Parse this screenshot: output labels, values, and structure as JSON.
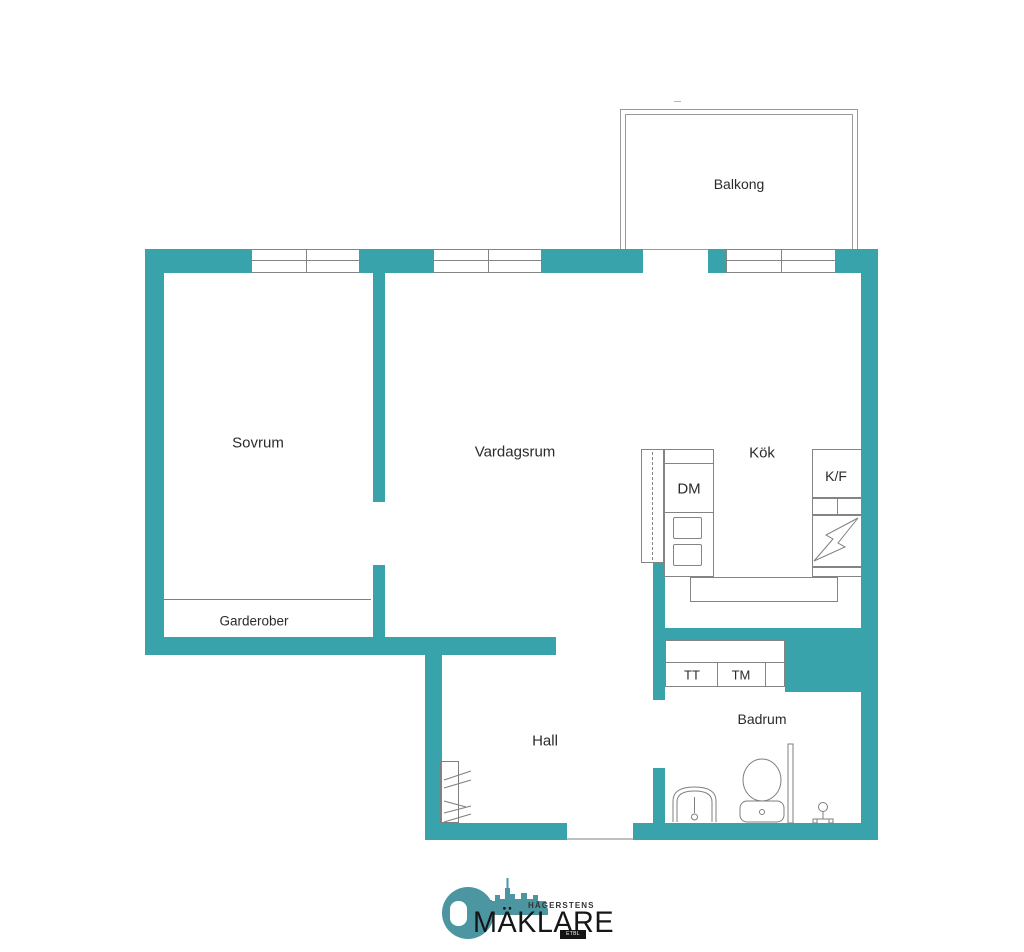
{
  "floorplan": {
    "rooms": {
      "balcony": "Balkong",
      "bedroom": "Sovrum",
      "living_room": "Vardagsrum",
      "kitchen": "Kök",
      "wardrobes": "Garderober",
      "hall": "Hall",
      "bathroom": "Badrum"
    },
    "appliances": {
      "dishwasher": "DM",
      "fridge_freezer": "K/F",
      "tumble_dryer": "TT",
      "washing_machine": "TM"
    },
    "colors": {
      "wall": "#38a3ab",
      "line": "#848484",
      "text": "#2b2b2b",
      "logo": "#4b96a0"
    }
  },
  "logo": {
    "top_text": "HÄGERSTENS",
    "main_text": "MÄKLARE",
    "est_text": "ETBL 1982"
  }
}
